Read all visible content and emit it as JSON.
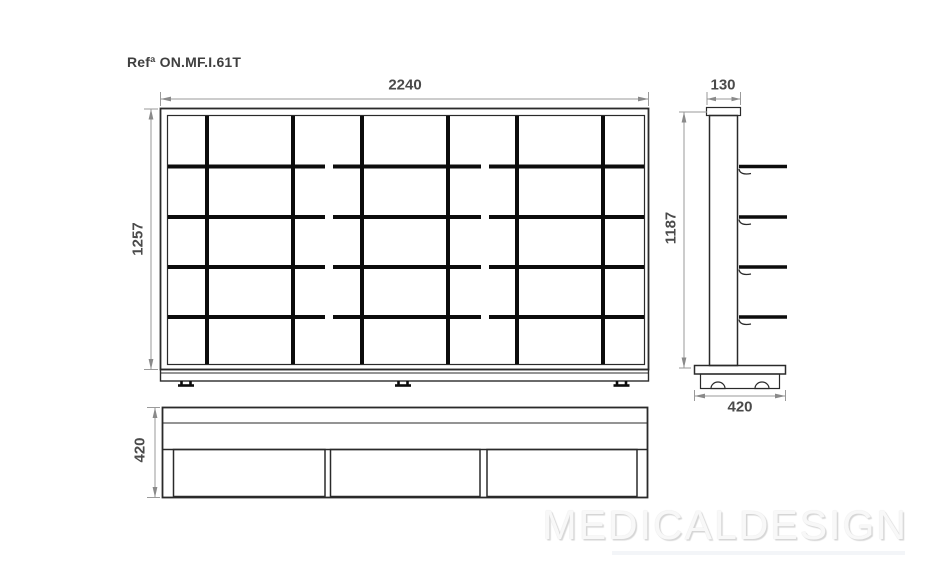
{
  "meta": {
    "ref_label": "Refª ON.MF.I.61T",
    "watermark": "MEDICALDESIGN"
  },
  "colors": {
    "background": "#ffffff",
    "outline": "#2a2a2a",
    "thick_line": "#0c0c0c",
    "dim_line": "#9a9a9a",
    "dim_arrow": "#8a8a8a",
    "dim_text": "#4a4a4a",
    "ref_text": "#3f3f3f",
    "watermark_text": "#f8f8f8",
    "watermark_shadow": "#d6d6d6"
  },
  "dimensions": {
    "front_width": "2240",
    "front_height": "1257",
    "side_top_width": "130",
    "side_height": "1187",
    "side_depth": "420",
    "plan_depth": "420"
  }
}
